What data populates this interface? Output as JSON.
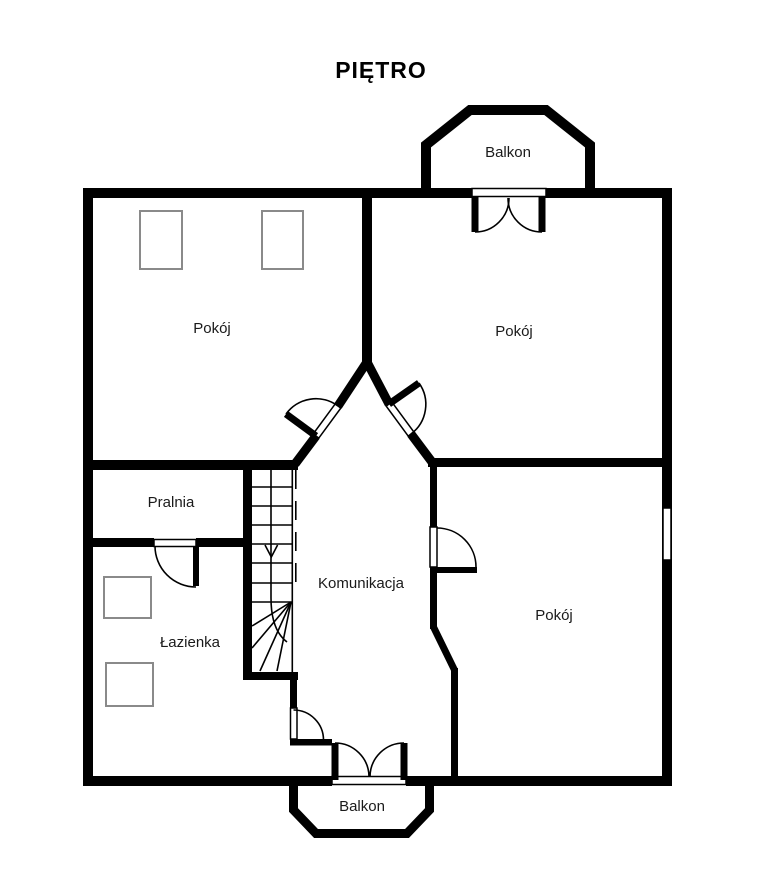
{
  "title": "PIĘTRO",
  "floor_plan": {
    "rooms": [
      {
        "id": "pokoj-top-left",
        "label": "Pokój"
      },
      {
        "id": "pokoj-top-right",
        "label": "Pokój"
      },
      {
        "id": "pralnia",
        "label": "Pralnia"
      },
      {
        "id": "lazienka",
        "label": "Łazienka"
      },
      {
        "id": "komunikacja",
        "label": "Komunikacja"
      },
      {
        "id": "pokoj-right",
        "label": "Pokój"
      },
      {
        "id": "balkon-top",
        "label": "Balkon"
      },
      {
        "id": "balkon-bottom",
        "label": "Balkon"
      }
    ],
    "features": {
      "stairs": "winder-staircase-down-arrow",
      "windows": 1,
      "doors": 7
    },
    "colors": {
      "walls": "#000000",
      "furniture_outline": "#8a8a8a",
      "background": "#ffffff",
      "text": "#1a1a1a"
    }
  }
}
